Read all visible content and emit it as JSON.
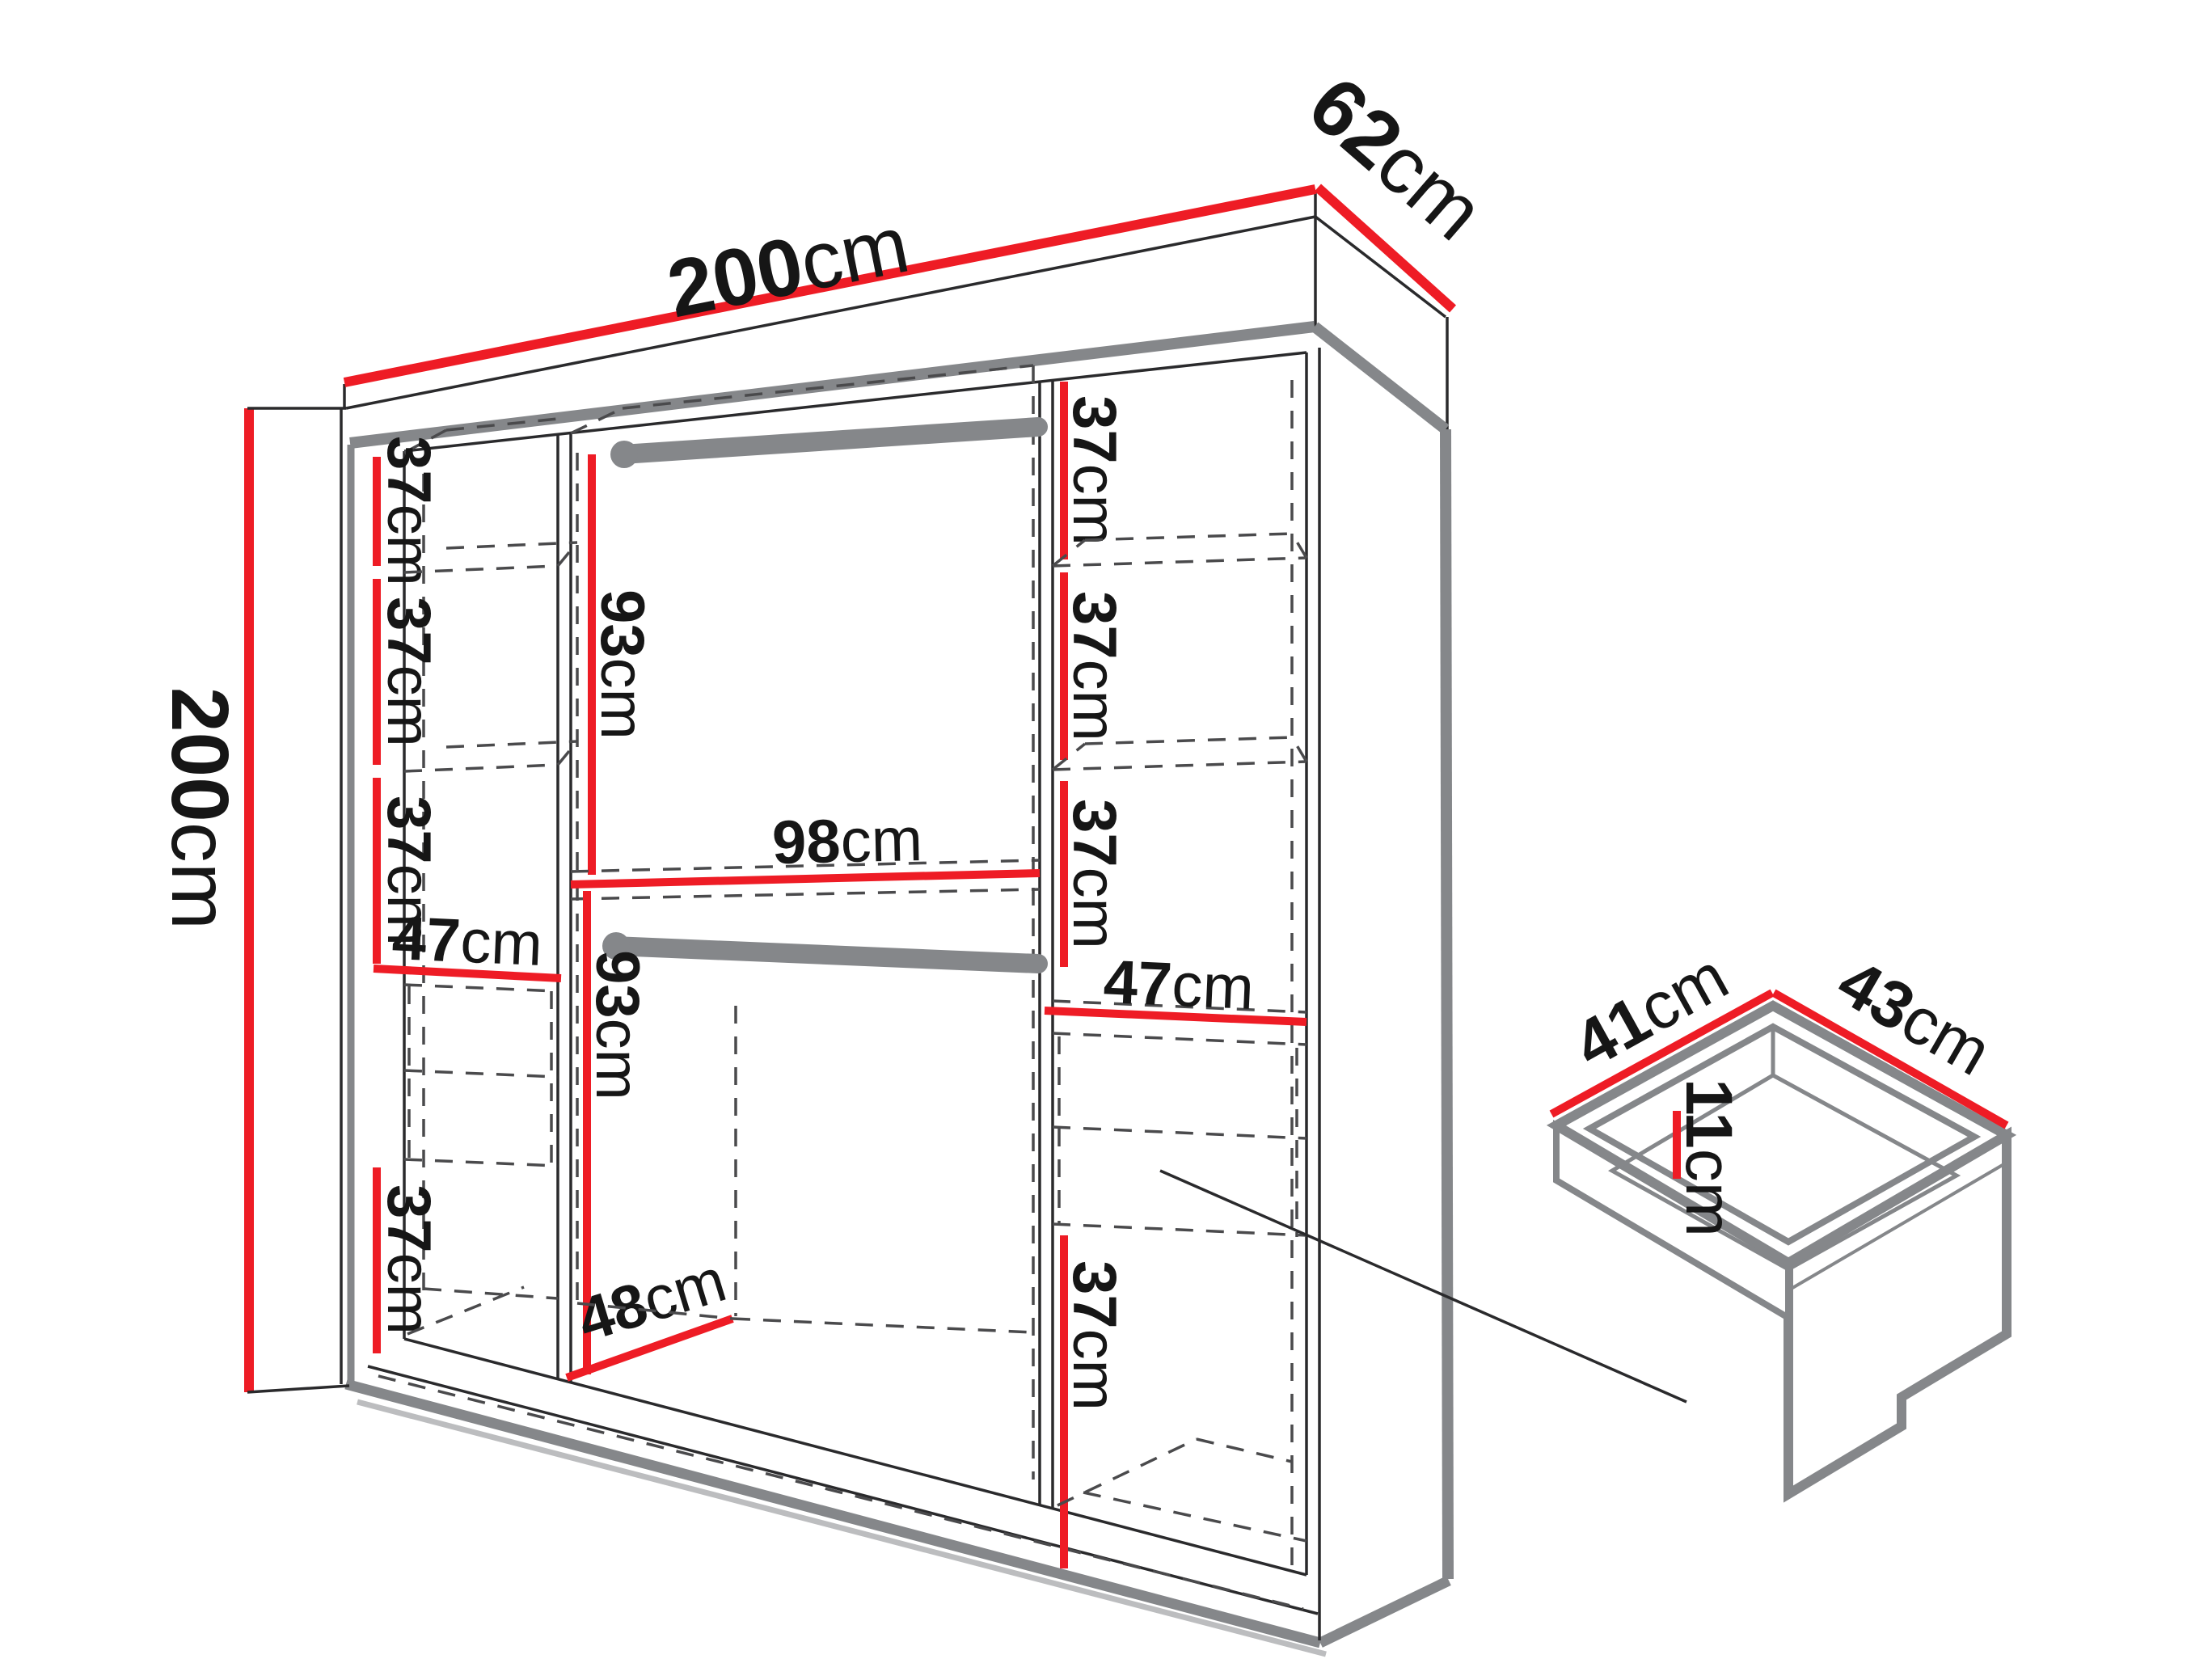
{
  "colors": {
    "dimension_red": "#ee1c25",
    "hardware_gray": "#85878a",
    "line_black": "#2a2a2c",
    "dashed_gray": "#4a4a4f",
    "text_black": "#161616"
  },
  "wardrobe": {
    "width": {
      "value": "200",
      "unit": "cm"
    },
    "depth": {
      "value": "62",
      "unit": "cm"
    },
    "height": {
      "value": "200",
      "unit": "cm"
    },
    "left_column": {
      "shelf_space_1": {
        "value": "37",
        "unit": "cm"
      },
      "shelf_space_2": {
        "value": "37",
        "unit": "cm"
      },
      "shelf_space_3": {
        "value": "37",
        "unit": "cm"
      },
      "shelf_width": {
        "value": "47",
        "unit": "cm"
      },
      "bottom_space": {
        "value": "37",
        "unit": "cm"
      }
    },
    "middle_section": {
      "upper_hanging": {
        "value": "93",
        "unit": "cm"
      },
      "width": {
        "value": "98",
        "unit": "cm"
      },
      "lower_hanging": {
        "value": "93",
        "unit": "cm"
      },
      "floor_depth": {
        "value": "48",
        "unit": "cm"
      }
    },
    "right_column": {
      "shelf_space_1": {
        "value": "37",
        "unit": "cm"
      },
      "shelf_space_2": {
        "value": "37",
        "unit": "cm"
      },
      "shelf_space_3": {
        "value": "37",
        "unit": "cm"
      },
      "shelf_width": {
        "value": "47",
        "unit": "cm"
      },
      "bottom_space": {
        "value": "37",
        "unit": "cm"
      }
    }
  },
  "drawer_detail": {
    "top_left_edge": {
      "value": "41",
      "unit": "cm"
    },
    "top_right_edge": {
      "value": "43",
      "unit": "cm"
    },
    "inner_height": {
      "value": "11",
      "unit": "cm"
    }
  }
}
